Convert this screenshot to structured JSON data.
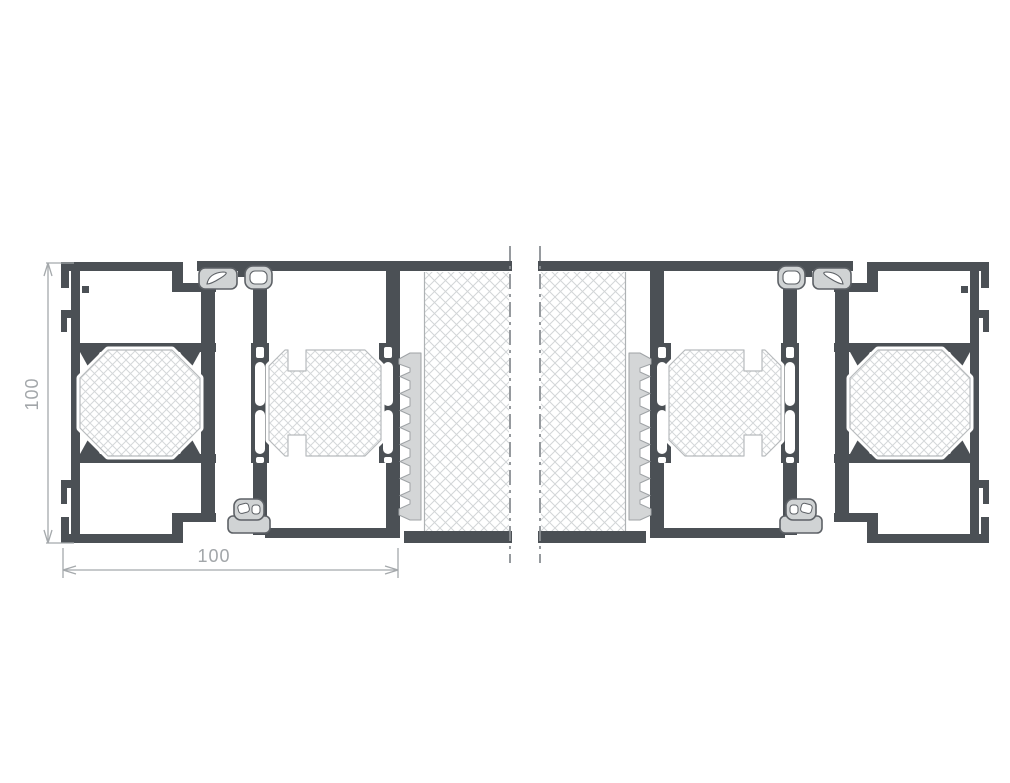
{
  "title": "Aluminium profile system cross-section, two mirrored jamb assemblies",
  "dimensions": {
    "height_label": "100",
    "width_label": "100"
  },
  "components": {
    "frame_profile": "outer frame profile with thermal break",
    "sash_profile": "sash profile with thermal break and gasket channels",
    "thermal_break": "cross-hatched polyamide insulation octagon",
    "gasket_top": "upper sealing gaskets",
    "gasket_bottom": "lower sealing gasket",
    "brush_seal": "serrated brush / fin seal",
    "wall_panel": "cross-hatched wall infill panel",
    "break_line": "dash-dot break centerlines"
  },
  "colors": {
    "profile_dark": "#4b5055",
    "gasket_gray": "#d0d3d4",
    "gasket_outline": "#5d6166",
    "brush_gray": "#d4d6d7",
    "brush_outline": "#9fa3a6",
    "hatch_line": "#d4d7d9",
    "octagon_outline": "#b7bbbd",
    "panel_border": "#aeb2b4",
    "centerline_gray": "#8b8f93",
    "dimension_gray": "#a2a6a9",
    "background": "#ffffff"
  }
}
